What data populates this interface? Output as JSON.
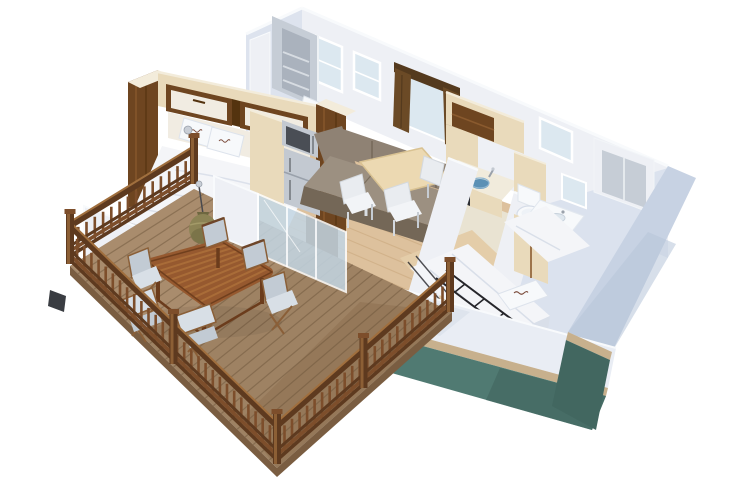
{
  "scene": {
    "type": "3d-cutaway-floor-plan",
    "setting": "Isometric 3D cutaway render of a two-bedroom mobile home with a large front wooden deck, floating on a white background",
    "rooms": [
      {
        "name": "master-bedroom",
        "items": [
          "double bed with white duvet",
          "two pillows with small brand logo",
          "overhead storage cabinets",
          "walnut wardrobe columns",
          "headboard panel"
        ]
      },
      {
        "name": "en-suite-shower-room",
        "items": [
          "grey shower cubicle with corner shelves",
          "white washbasin",
          "tall back-wall window"
        ]
      },
      {
        "name": "kitchen",
        "items": [
          "light-wood overhead cabinets with walnut niche",
          "counter with blue bowl sink",
          "chrome faucet",
          "black coffee machine",
          "stainless microwave",
          "stainless fridge",
          "tall larder cabinet"
        ]
      },
      {
        "name": "living-dining",
        "items": [
          "taupe corner sofa",
          "light-wood dining table",
          "four white chairs",
          "window with brown curtains",
          "two back-wall windows"
        ]
      },
      {
        "name": "bathroom",
        "items": [
          "toilet",
          "vanity with inset washbasin",
          "mirror",
          "back-wall window",
          "corner shower room"
        ]
      },
      {
        "name": "twin-bedroom",
        "items": [
          "two single beds with white linen",
          "pillow with small brand logo",
          "black folded bunk ladder frame",
          "light-wood wardrobe"
        ]
      },
      {
        "name": "deck-terrace",
        "items": [
          "hardwood decking boards",
          "wooden balustrade railing with posts",
          "rectangular wooden dining table",
          "six folding chairs with pale blue-grey fabric",
          "olive pendant lamp",
          "glass sliding doors"
        ]
      }
    ],
    "exterior": {
      "walls": "white / pale blue-grey panels",
      "end_wall": "light blue-grey",
      "skirt": "teal-green base band",
      "trim": "tan base strip"
    },
    "logos": {
      "pillow_brand_marks": "tiny reddish-brown script logo printed on pillows (too small to read)"
    }
  },
  "palette": {
    "background": "#ffffff",
    "backWall": "#eef0f5",
    "wallShade": "#dde3ee",
    "wallBright": "#f8fafc",
    "interiorRightFace": "#dbe2ee",
    "exteriorRightWall": "#c7d2e3",
    "exteriorFrontWall": "#e9edf4",
    "skirtTeal": "#507a72",
    "skirtTealDark": "#426760",
    "baseTrimTan": "#c7b08d",
    "windowGlass": "#dce8f0",
    "glassDoor": "#c3d6e4",
    "floorWood": "#ddc19d",
    "floorLine": "#c3a074",
    "bathFloor": "#e9e3d2",
    "twinFloor": "#e4cda9",
    "deckWood": "#9e8263",
    "deckLight": "#b49678",
    "deckLine": "#6e563c",
    "deckEdge": "#7a5d41",
    "railWood": "#7d4e2b",
    "railDark": "#5e3a1f",
    "railLight": "#a06f3e",
    "postCap": "#c9ced6",
    "walnut": "#6e4520",
    "walnutDark": "#54330f",
    "walnutLight": "#8a5a2e",
    "ashWood": "#e9dabb",
    "ashEdge": "#f3ecdb",
    "creamPanel": "#f1ece2",
    "linen": "#f4f5f8",
    "linenShadow": "#d9dfe9",
    "pillowLogo": "#7a4a3a",
    "sofa": "#8f8274",
    "sofaDark": "#746757",
    "sofaLight": "#9c9081",
    "curtain": "#6b4a26",
    "curtainDark": "#543a1e",
    "tableWood": "#96592f",
    "tableLight": "#b5793f",
    "tableDark": "#6b3c1c",
    "chairFabric": "#c2cbd4",
    "chairFabricLight": "#d8dfe6",
    "whiteChair": "#e9ecf0",
    "lampOlive": "#8c8355",
    "lampDark": "#6e6740",
    "steel": "#c3c9d1",
    "steelDark": "#9aa1ab",
    "dark": "#2c2e33",
    "ceramic": "#f7f9fb",
    "basinBlue": "#4a86b0",
    "showerGray": "#c6cdd6",
    "showerGrayDark": "#aab2bd",
    "ladder": "#26262b"
  }
}
